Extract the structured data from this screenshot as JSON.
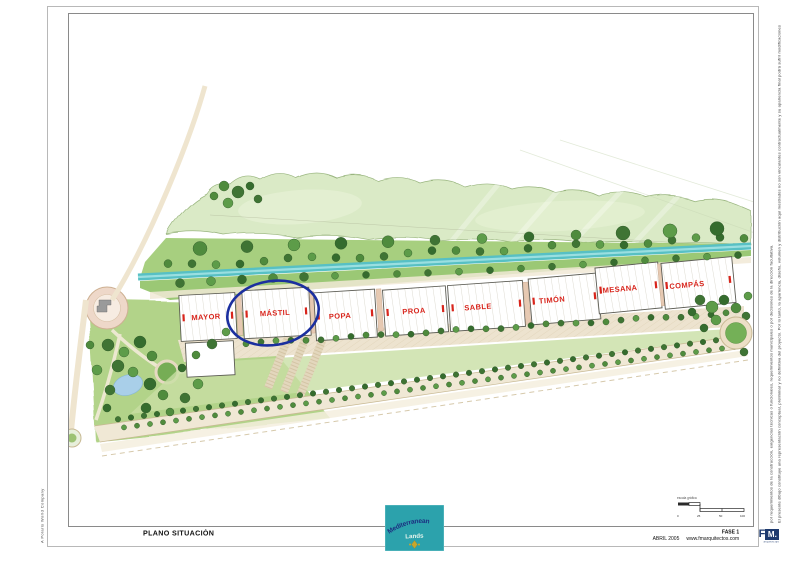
{
  "page": {
    "left_vertical_text": "A Polaris World Company",
    "right_disclaimer_line1": "El presente dibujo constituye una representación conceptual, preliminar y no definitiva del proyecto. Por lo tanto, la apariencia, diseño, volumen y distribución aquí mostrados no son vinculantes contractualmente y su apariencia final podrá sufrir modificaciones",
    "right_disclaimer_line2": "por requerimientos de la construcción, exigencias técnicas o funcionales, requerimientos municipales o por decisiones de la dirección facultativa."
  },
  "title_block": {
    "drawing_title": "PLANO SITUACIÓN",
    "phase": "FASE 1",
    "date": "ABRIL 2005",
    "website": "www.fmarquitectos.com",
    "architect_logo": {
      "f": "F",
      "m": "M.",
      "subtext": "arquitectos"
    },
    "developer_logo": {
      "line1": "Mediterranean",
      "line2": "Lands"
    }
  },
  "plan": {
    "buildings": [
      {
        "name": "MAYOR"
      },
      {
        "name": "MÁSTIL"
      },
      {
        "name": "POPA"
      },
      {
        "name": "PROA"
      },
      {
        "name": "SABLE"
      },
      {
        "name": "TIMÓN"
      },
      {
        "name": "MESANA"
      },
      {
        "name": "COMPÁS"
      }
    ],
    "highlight": {
      "circled_building": "MÁSTIL",
      "color": "#1b2f9f"
    },
    "scale_bar": {
      "label": "escala gráfica",
      "ticks": [
        "0",
        "25",
        "50",
        "100"
      ]
    }
  },
  "colors": {
    "label_red": "#d8251c",
    "highlight_blue": "#1b2f9f",
    "canal_teal": "#57c0c4",
    "logo_teal": "#2ca2ac",
    "logo_navy": "#1e3a6e",
    "gold": "#c8a62c"
  }
}
